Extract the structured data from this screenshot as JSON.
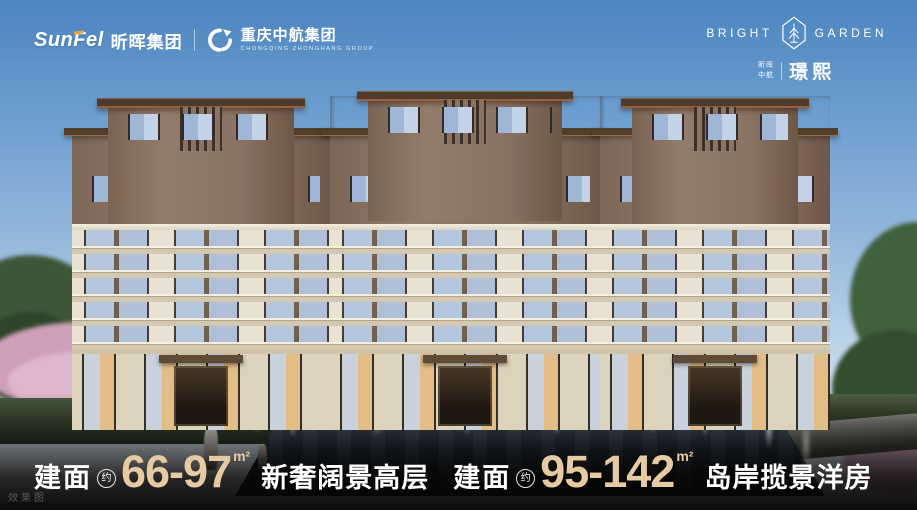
{
  "header": {
    "sunfel": {
      "logo_text": "SunFel",
      "cn_name": "昕晖集团",
      "accent_color": "#f0a32f"
    },
    "zhonghang": {
      "icon": "swirl-phoenix-icon",
      "cn_name": "重庆中航集团",
      "en_name": "CHONGQING ZHONGHANG GROUP"
    },
    "brand": {
      "name_left": "BRIGHT",
      "name_right": "GARDEN",
      "emblem_icon": "hexagon-tree-icon",
      "sub_top": "昕晖",
      "sub_bottom": "中航",
      "sub_name": "璟熙"
    }
  },
  "tagline": {
    "segments": [
      {
        "label": "建面",
        "approx": "约",
        "range": "66-97",
        "unit": "m²",
        "title": "新奢阔景高层"
      },
      {
        "label": "建面",
        "approx": "约",
        "range": "95-142",
        "unit": "m²",
        "title": "岛岸揽景洋房"
      }
    ]
  },
  "watermark": "效果图",
  "colors": {
    "accent_gold": "#e6cba2",
    "sky_top": "#4c85c0",
    "facade_cream": "#e9e2d2",
    "facade_brown": "#8a7263",
    "roof_brown": "#4e3b2b",
    "glass_blue": "#b4c6dd"
  }
}
